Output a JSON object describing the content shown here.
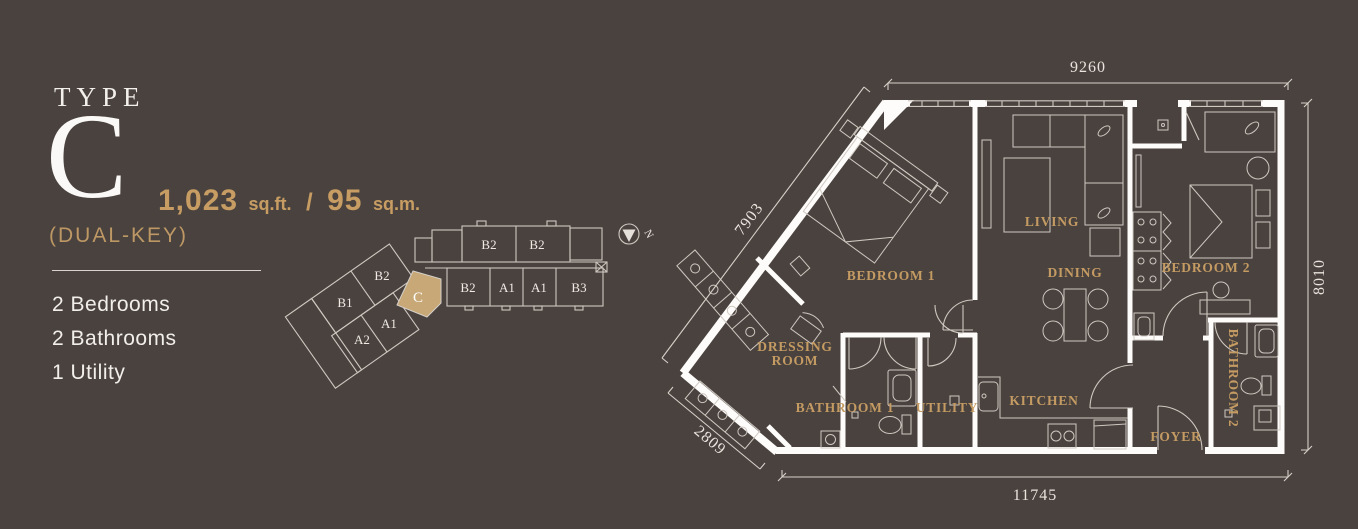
{
  "colors": {
    "background": "#4a423e",
    "gold": "#c49b63",
    "highlight_tan": "#c7a876",
    "text_white": "#f2eeea",
    "line": "#d6d0c9"
  },
  "panel": {
    "type_label": "TYPE",
    "type_letter": "C",
    "area_value_ft": "1,023",
    "area_unit_ft": "sq.ft.",
    "area_separator": "/",
    "area_value_m": "95",
    "area_unit_m": "sq.m.",
    "key_type": "(DUAL-KEY)",
    "features": [
      "2 Bedrooms",
      "2 Bathrooms",
      "1 Utility"
    ]
  },
  "keyplan": {
    "wing_top": [
      "B2",
      "B2"
    ],
    "wing_bottom": [
      "B2",
      "A1",
      "A1",
      "B3"
    ],
    "wing_diagonal": [
      "B2",
      "B1",
      "A1",
      "A2"
    ],
    "highlighted_unit": "C"
  },
  "compass": {
    "north": "N"
  },
  "floorplan": {
    "rooms": {
      "bedroom1": "BEDROOM 1",
      "dressing_line1": "DRESSING",
      "dressing_line2": "ROOM",
      "bathroom1": "BATHROOM 1",
      "utility": "UTILITY",
      "kitchen": "KITCHEN",
      "living": "LIVING",
      "dining": "DINING",
      "bedroom2": "BEDROOM 2",
      "bathroom2": "BATHROOM 2",
      "foyer": "FOYER"
    },
    "dimensions": {
      "top": "9260",
      "right": "8010",
      "bottom": "11745",
      "upper_left": "7903",
      "lower_left": "2809"
    }
  }
}
